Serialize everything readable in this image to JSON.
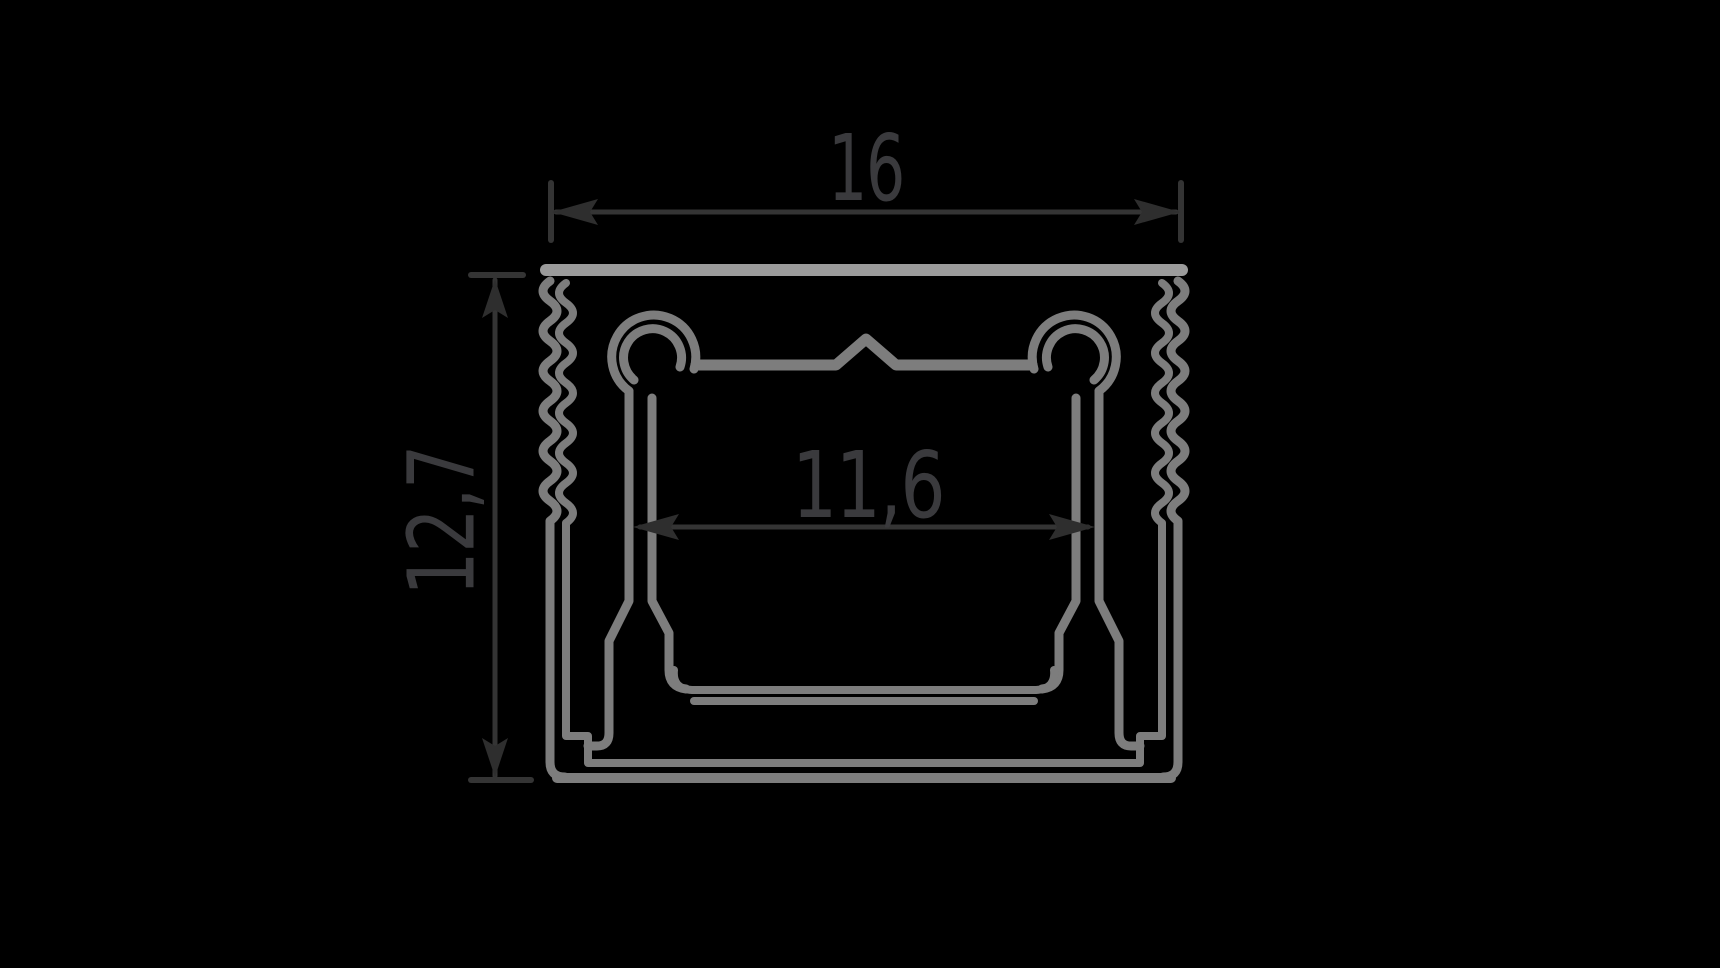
{
  "page": {
    "background_color": "#000000"
  },
  "drawing": {
    "kind": "profile-cross-section-technical-drawing",
    "outline_color": "#7d7d7d",
    "top_rim_color": "#9b9b9b",
    "dimension_line_color": "#343434",
    "label_color": "#3a3a3d",
    "labels": {
      "overall_width": "16",
      "overall_height": "12,7",
      "inner_width": "11,6"
    }
  }
}
